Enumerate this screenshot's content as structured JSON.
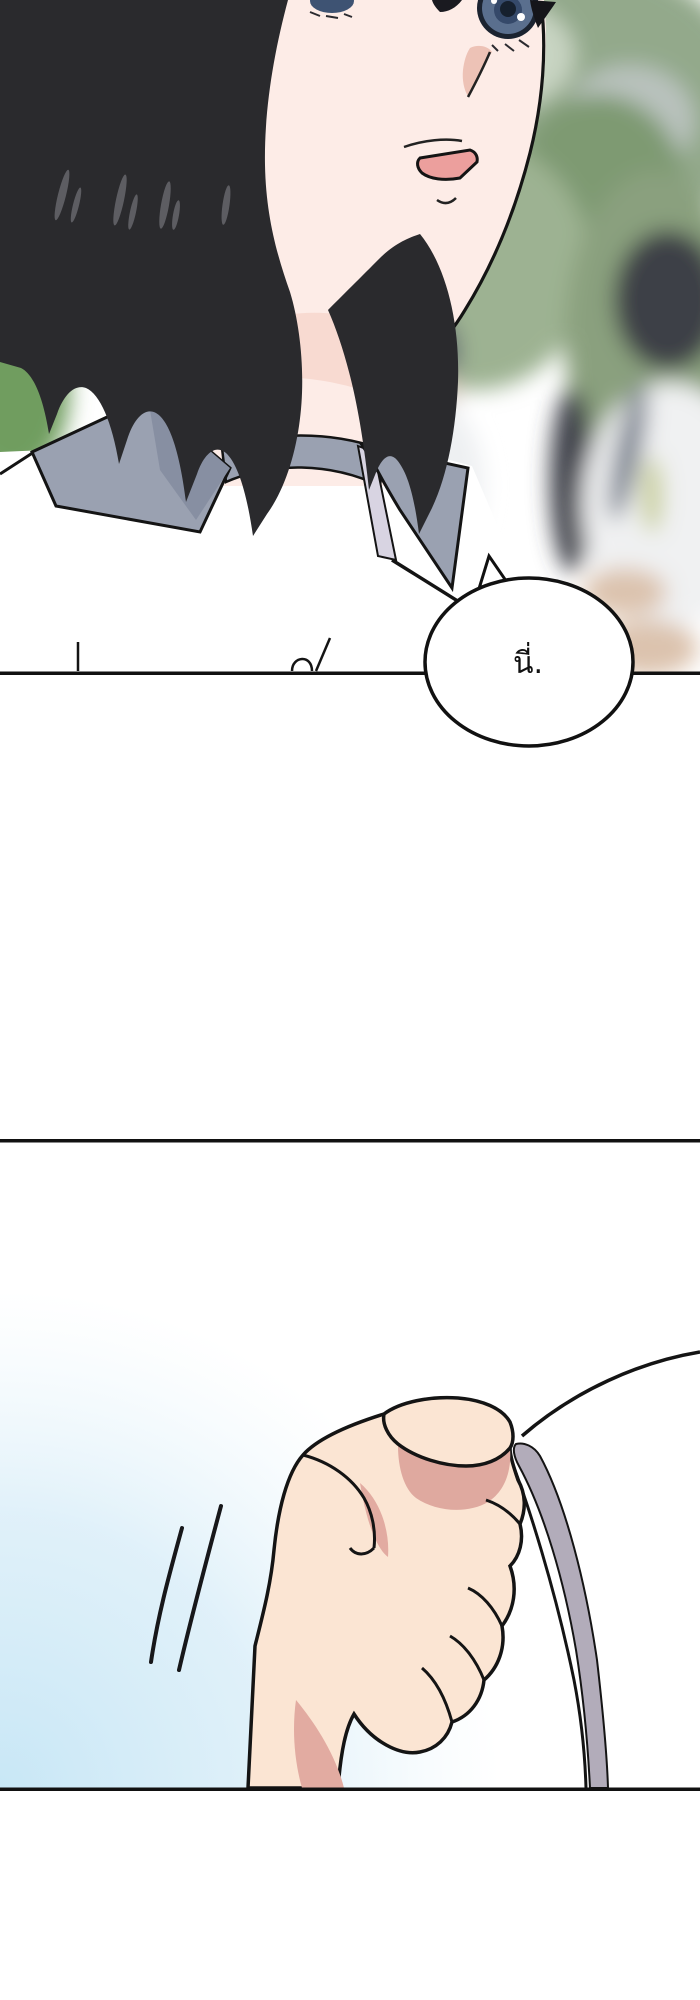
{
  "page": {
    "type": "comic-page",
    "background_color": "#ffffff"
  },
  "speech_bubble": {
    "text": "นี่.",
    "fill": "#ffffff",
    "stroke": "#111111"
  },
  "panels": [
    {
      "name": "panel-1",
      "description": "Close-up of a short black-haired student in a white shirt with a gray collar glancing sideways; blurred schoolyard with green foliage and other students behind."
    },
    {
      "name": "panel-2",
      "description": "A hand tightly gripping the curled corner of a white sheet of paper, with two motion lines, over a soft blue wash."
    }
  ],
  "colors": {
    "skin": "#fdece7",
    "hand_skin": "#fbe5d3",
    "shadow_pink": "#dfa99f",
    "hair": "#2a2a2d",
    "hair_highlight": "#5d5d62",
    "collar_gray": "#9aa1b1",
    "collar_shade": "#878fa2",
    "collar_inner": "#d8d4e2",
    "iris_blue": "#5a6f8e",
    "iris_dark": "#1b2330",
    "mouth_pink": "#ec9f9d",
    "nose_shadow": "#edc2b6",
    "neck_shadow": "#f6d6cc",
    "foliage_green": "#93a98b",
    "foliage_dark": "#7e9a72",
    "paper_edge_gray": "#b2acba",
    "panel_line": "#111111",
    "blue_wash": "#c8e7f6",
    "line_art": "#141414"
  }
}
